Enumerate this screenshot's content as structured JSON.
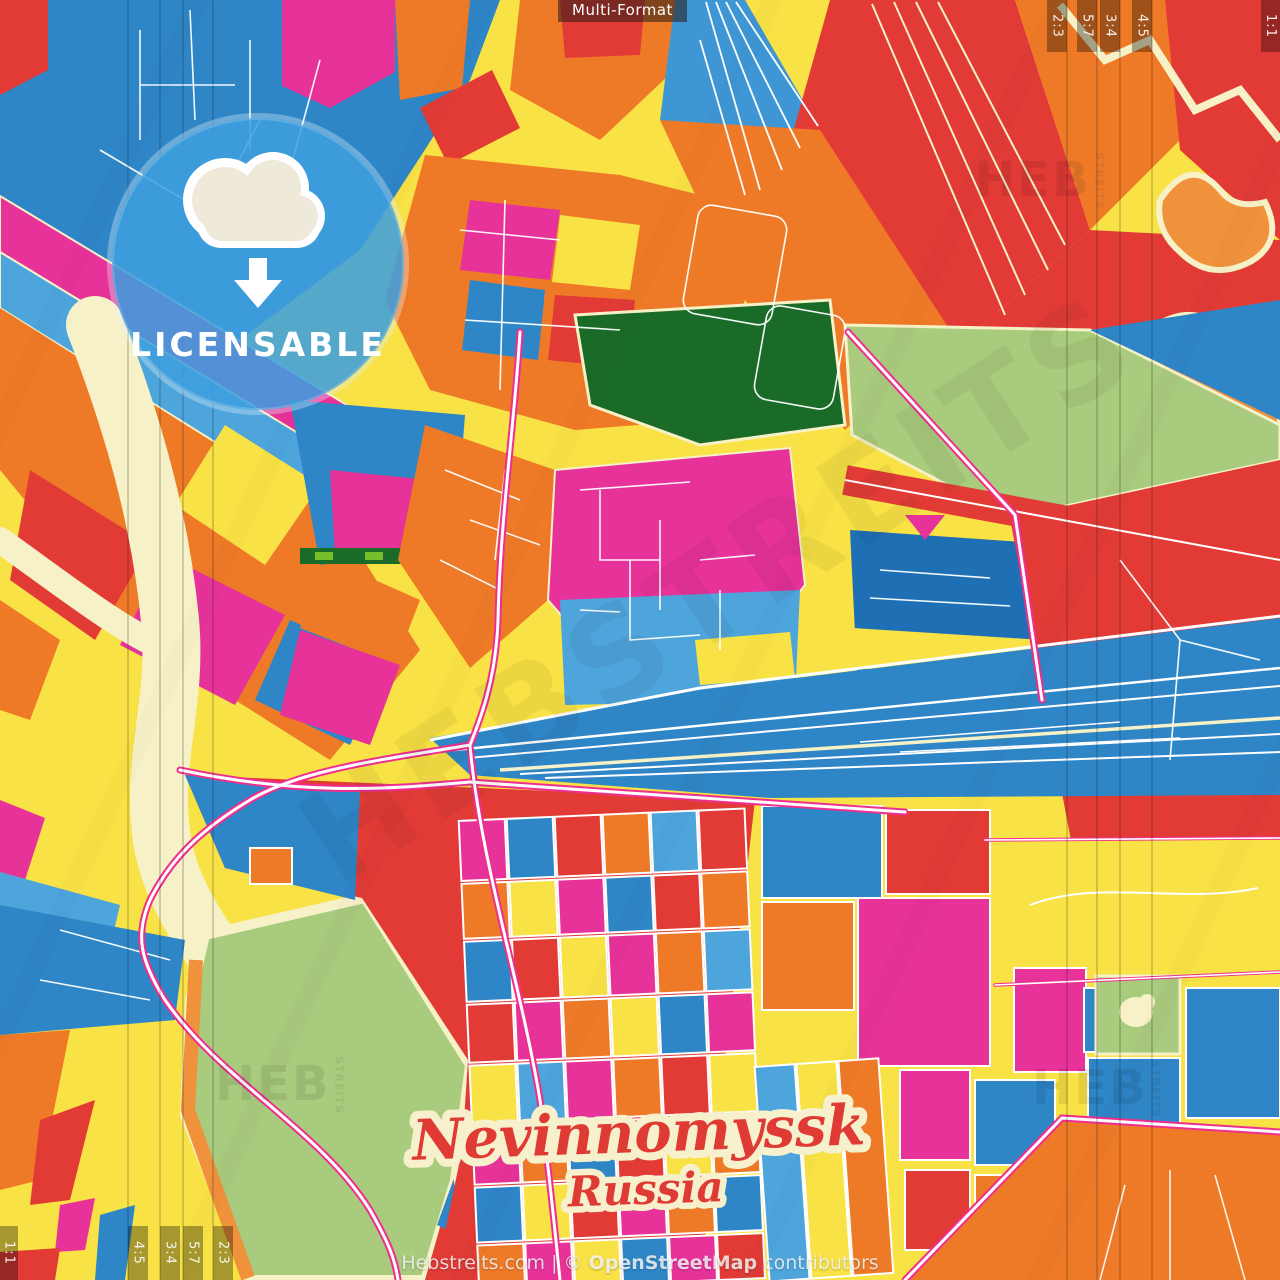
{
  "header": {
    "format_label": "Multi-Format"
  },
  "badge": {
    "label": "LICENSABLE",
    "icon": "cloud-download-icon"
  },
  "map": {
    "city": "Nevinnomyssk",
    "country": "Russia"
  },
  "crop_guides": {
    "top_right": [
      "2:3",
      "5:7",
      "3:4",
      "4:5"
    ],
    "top_right_edge": "1:1",
    "bottom_left": [
      "4:5",
      "3:4",
      "5:7",
      "2:3"
    ],
    "bottom_left_edge": "1:1"
  },
  "watermark": {
    "brand_short": "HEB",
    "brand_side": "STREITS",
    "brand_full": "HEBSTREITS"
  },
  "footer": {
    "site": "Hebstreits.com",
    "separator": "|",
    "copyright": "©",
    "attribution": "OpenStreetMap",
    "suffix": "contributors"
  },
  "palette": {
    "red": "#e23b36",
    "orange": "#ee7a28",
    "orange_light": "#f0913b",
    "yellow": "#f8e245",
    "magenta": "#e7329a",
    "blue": "#2e86c7",
    "blue_light": "#4ea5dc",
    "blue_dark": "#1f6fb5",
    "cream": "#f6f1c6",
    "green_light": "#a9cb7d",
    "green_dark": "#1b6b28",
    "road_pink": "#ef2f8f",
    "badge_blue": "#3f9fde"
  }
}
